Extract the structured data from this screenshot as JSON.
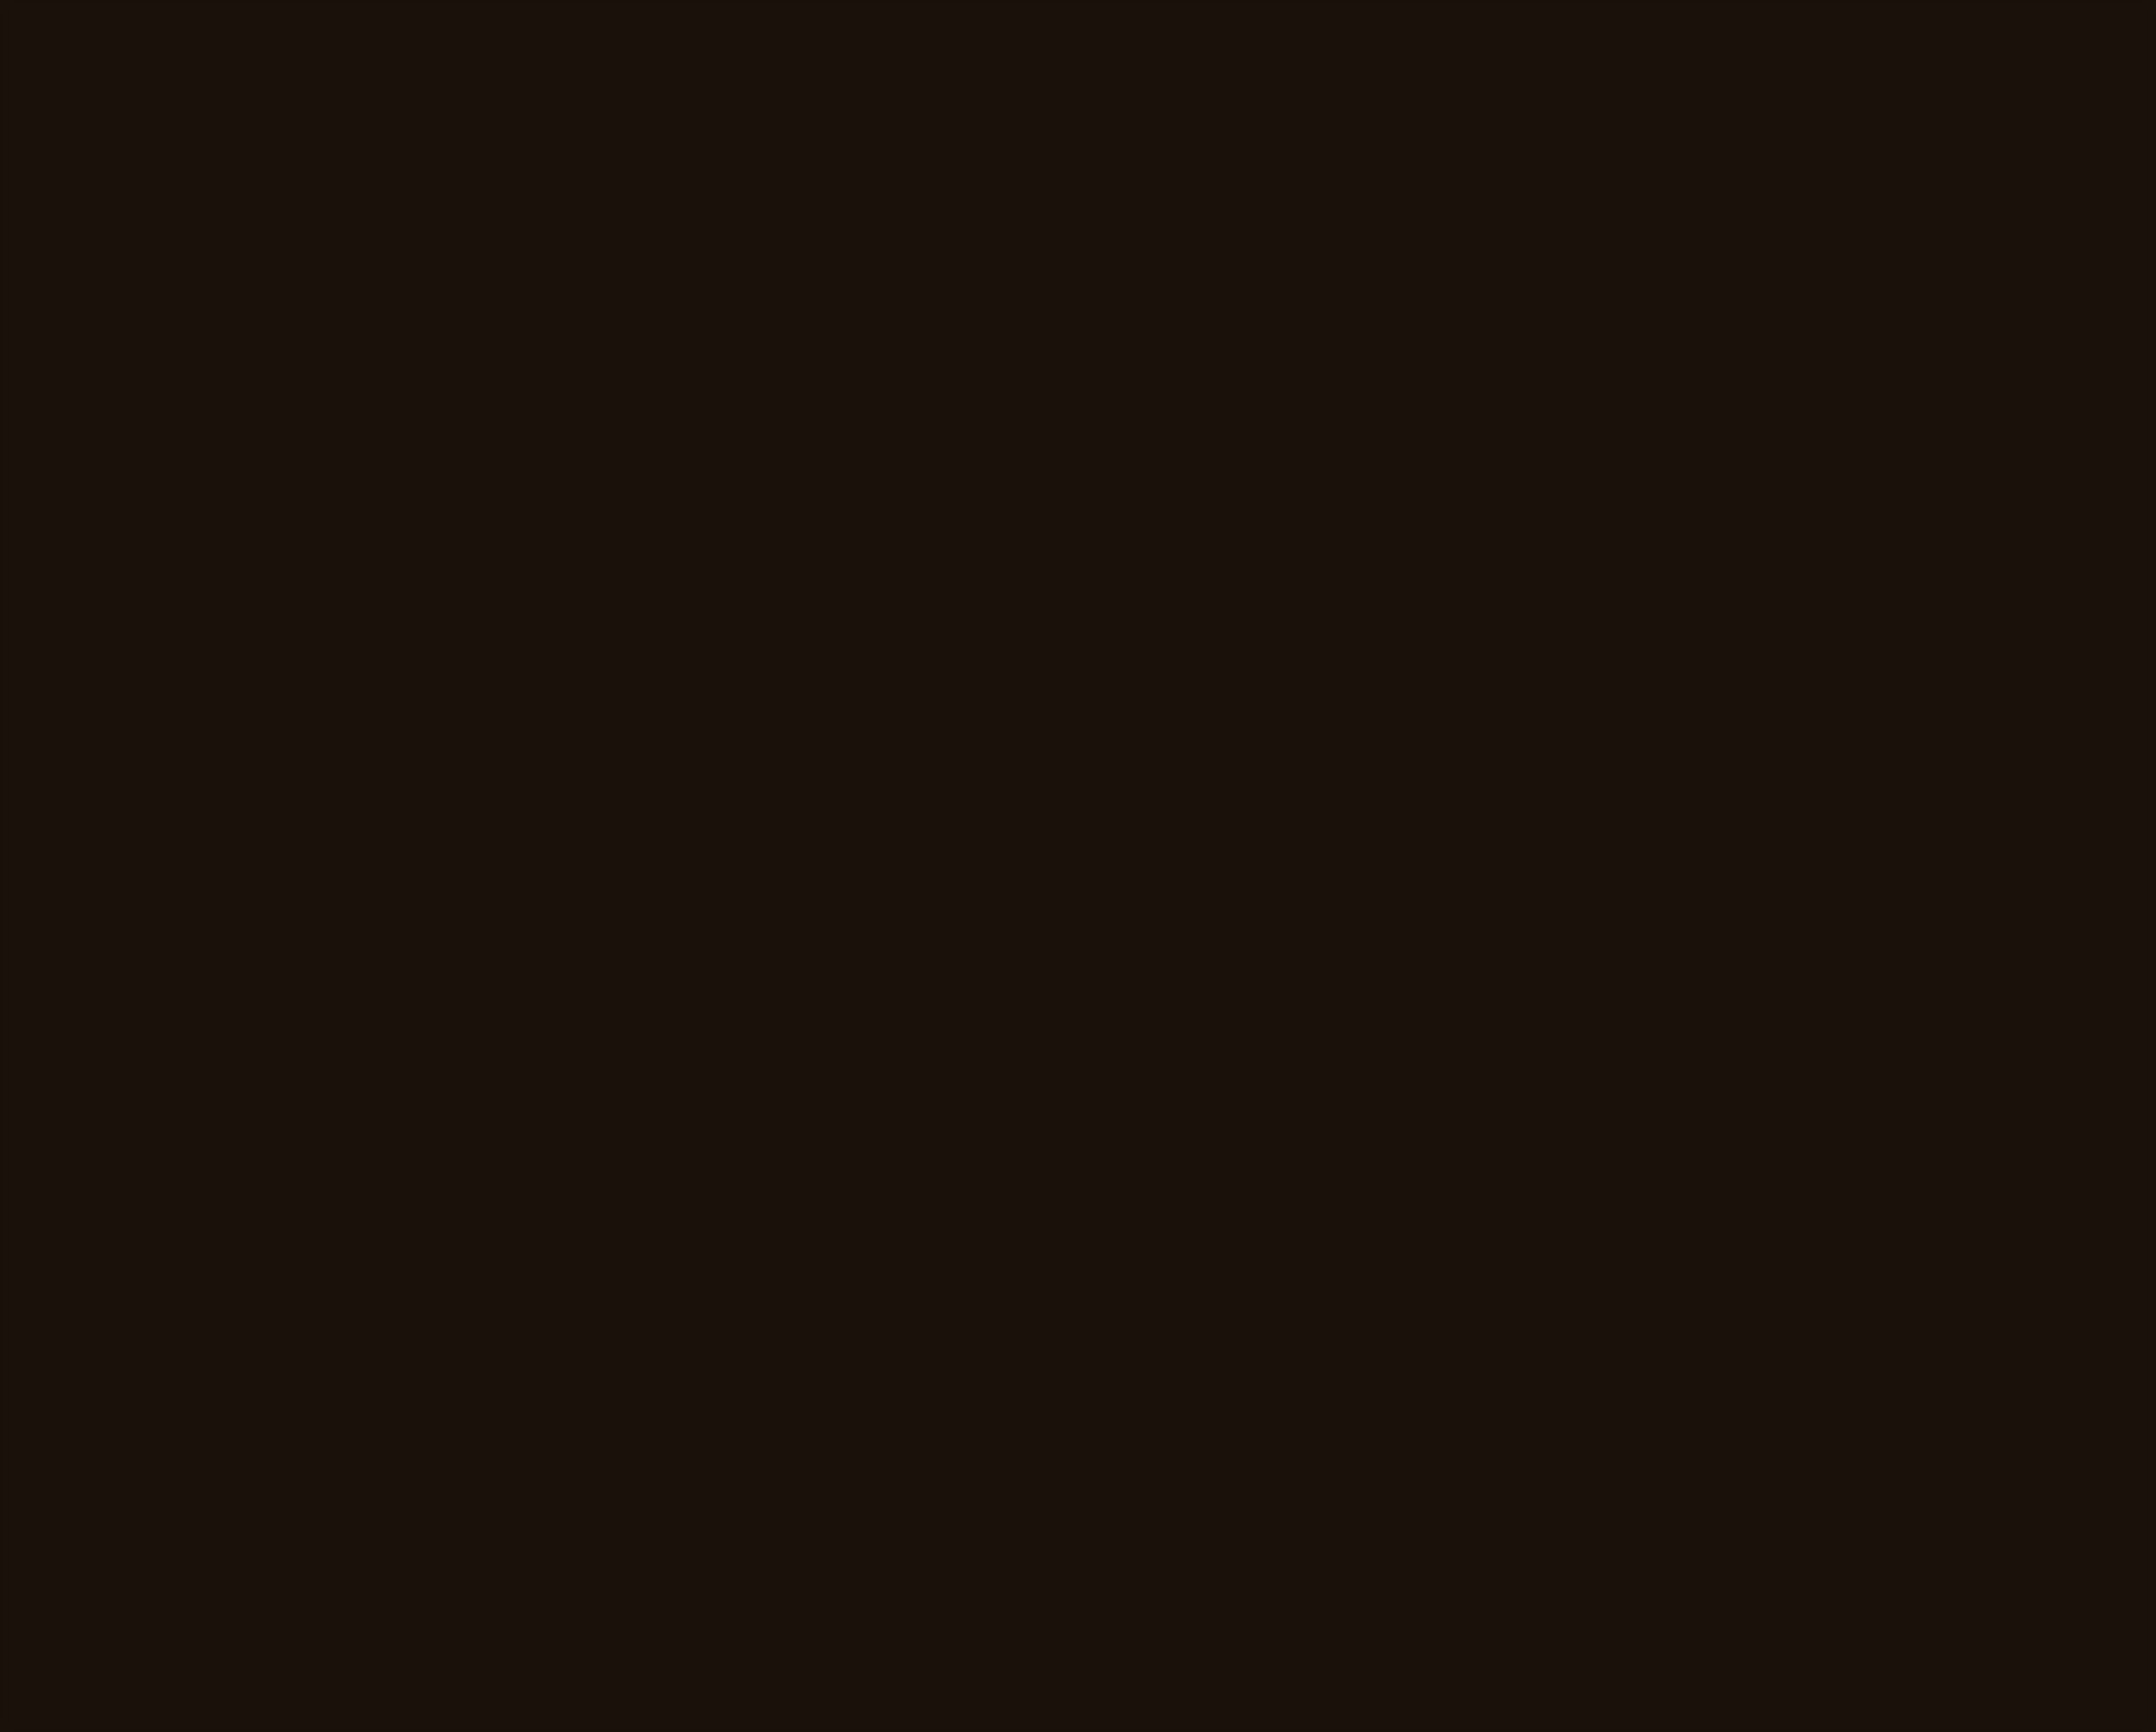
{
  "floor_plan": {
    "title": "1st Floor Plan",
    "rooms": {
      "bedroom_left": {
        "name": "BED ROOM",
        "size": "14'x12'"
      },
      "bedroom_mid": {
        "name": "BED ROOM",
        "size": "14x13'"
      },
      "bedroom_right": {
        "name": "BED ROOM",
        "size": "13'x15'"
      },
      "bedroom_far_right": {
        "name": "BED ROOM",
        "size": "13'x19'6\""
      },
      "kitchen": {
        "name": "KITCHEN",
        "size": "6'11\"x7'"
      },
      "dining": {
        "name": "DINING",
        "size": "11'x12'6\""
      },
      "living": {
        "name": "LIVING ROOM",
        "size": ""
      },
      "toilet": {
        "name": "TOILET",
        "size": ""
      },
      "bath": {
        "name": "BATH",
        "size": ""
      }
    },
    "balconies": {
      "left": {
        "name": "BALCONY",
        "size": "10'x3'"
      },
      "mid": {
        "name": "BALCONY",
        "size": "9'x3'6\""
      },
      "right": {
        "name": "BALCONY",
        "size": "10'x3'6\""
      },
      "far_left": {
        "name": "BALCONY",
        "size": ""
      }
    },
    "markers": {
      "w1": "W1",
      "w2": "W2",
      "w3": "W3",
      "d2": "D2",
      "d3": "D3"
    }
  },
  "objects": {
    "glasses": {
      "frame_color": "#140f0b"
    },
    "pen": {
      "body_color": "#120b07"
    },
    "folding_ruler": {
      "color": "#e3c678"
    },
    "tape_measure": {
      "body_color": "#1d1310",
      "stripe_color": "#dd4b22",
      "clip_color": "#c9c3b6"
    },
    "paper": {
      "color": "#f3f1ea"
    },
    "table": {
      "wood_color": "#b08457"
    }
  }
}
